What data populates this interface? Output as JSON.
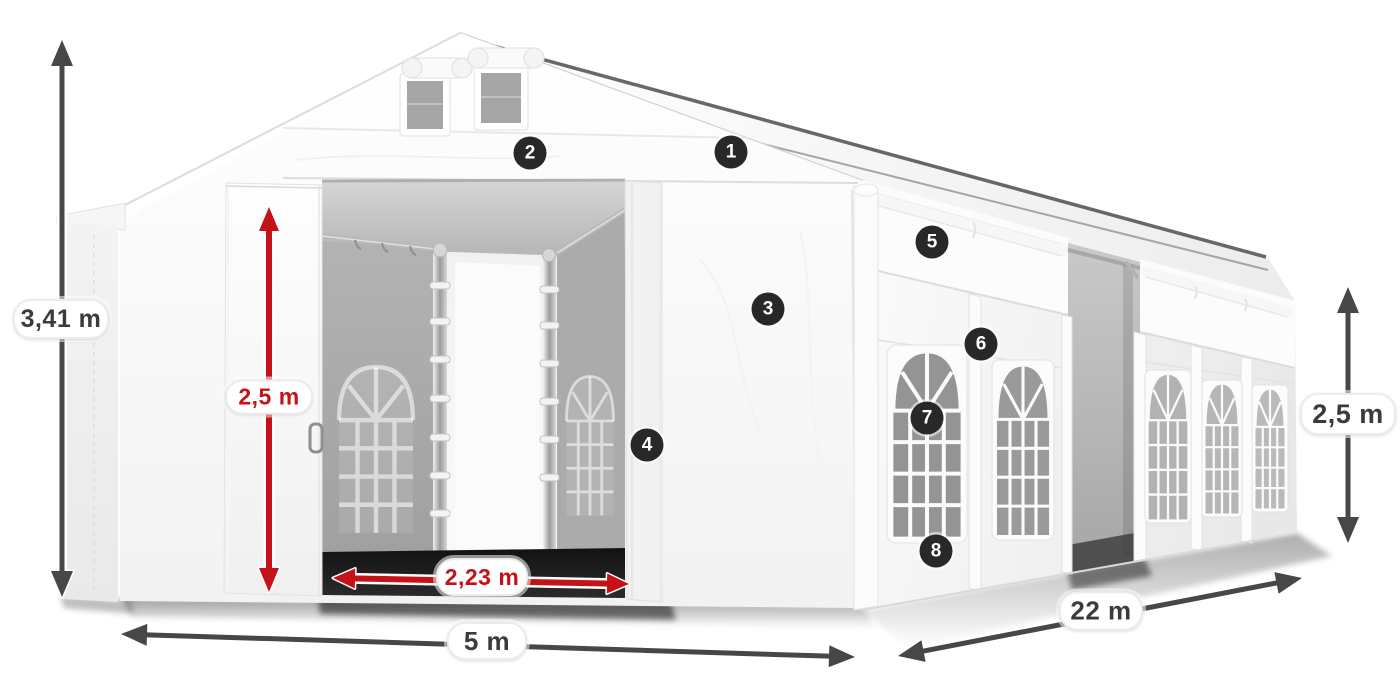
{
  "illustration": {
    "alt": "White marquee party tent with open sliding front doors, arched side windows and dimension annotations"
  },
  "dimensions": {
    "total_height": {
      "label": "3,41 m",
      "color": "dark"
    },
    "door_height": {
      "label": "2,5 m",
      "color": "red"
    },
    "door_width": {
      "label": "2,23 m",
      "color": "red"
    },
    "front_width": {
      "label": "5 m",
      "color": "dark"
    },
    "side_length": {
      "label": "22 m",
      "color": "dark"
    },
    "side_height": {
      "label": "2,5 m",
      "color": "dark"
    }
  },
  "callouts": [
    {
      "label": "1"
    },
    {
      "label": "2"
    },
    {
      "label": "3"
    },
    {
      "label": "4"
    },
    {
      "label": "5"
    },
    {
      "label": "6"
    },
    {
      "label": "7"
    },
    {
      "label": "8"
    }
  ],
  "colors": {
    "accent_red": "#c51218",
    "dimension_dark": "#474747",
    "badge_background": "#282828",
    "badge_text": "#ffffff",
    "background": "#ffffff"
  }
}
